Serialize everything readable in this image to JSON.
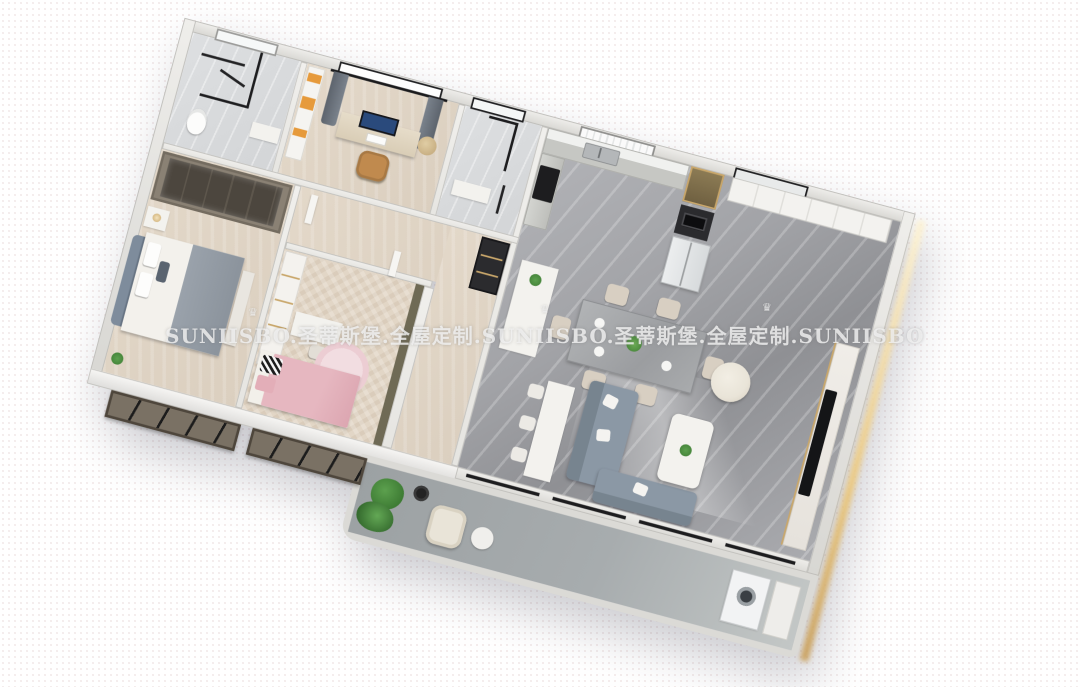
{
  "watermark": {
    "text": "SUNIISBO.圣蒂斯堡.全屋定制.SUNIISBO.圣蒂斯堡.全屋定制.SUNIISBO",
    "brand_latin": "SUNIISBO",
    "brand_cn": "圣蒂斯堡",
    "tagline_cn": "全屋定制",
    "crown_glyph": "♛"
  },
  "palette": {
    "page-bg": "#ffffff",
    "dot": "#e8d8d8",
    "wall": "#e6e5e1",
    "wall-edge": "#c2c1bd",
    "wall-outer": "#d8d7d3",
    "floor-marble": "#a2a3a7",
    "floor-marble-light": "#d3d5d7",
    "floor-wood": "#dbcfbf",
    "floor-herringbone": "#e2d6c6",
    "floor-balcony": "#a7acae",
    "gold": "#c9a76b",
    "glow": "#ecc97f",
    "sofa": "#8b98a5",
    "sofa-dark": "#77848f",
    "cream": "#e9e4d8",
    "chair-beige": "#d8cfc2",
    "pink": "#e6b7c0",
    "pink-light": "#eccdd3",
    "headboard": "#7e8c9c",
    "blanket": "#9aa2ab",
    "wardrobe": "#8a8174",
    "wardrobe-glass": "#4c463e",
    "olive": "#6f6a55",
    "bay": "#7a7164",
    "white-furn": "#f3f2ee",
    "dark-unit": "#2b2b2e",
    "plant": "#3e7c34",
    "plant-light": "#5ca04e",
    "tv": "#141517",
    "screen-blue": "#2a4a7c",
    "camel": "#c08a4e",
    "orange": "#e69a3b",
    "black": "#1d1d1f",
    "watermark-color": "rgba(242,242,242,0.82)"
  },
  "scene": {
    "description": "3D cutaway floor plan render of an apartment",
    "rooms": [
      "bathroom-main",
      "study",
      "bathroom-2",
      "kitchen",
      "entry",
      "master-bedroom",
      "kids-bedroom",
      "hallway",
      "dining-area",
      "living-room",
      "balcony"
    ]
  }
}
